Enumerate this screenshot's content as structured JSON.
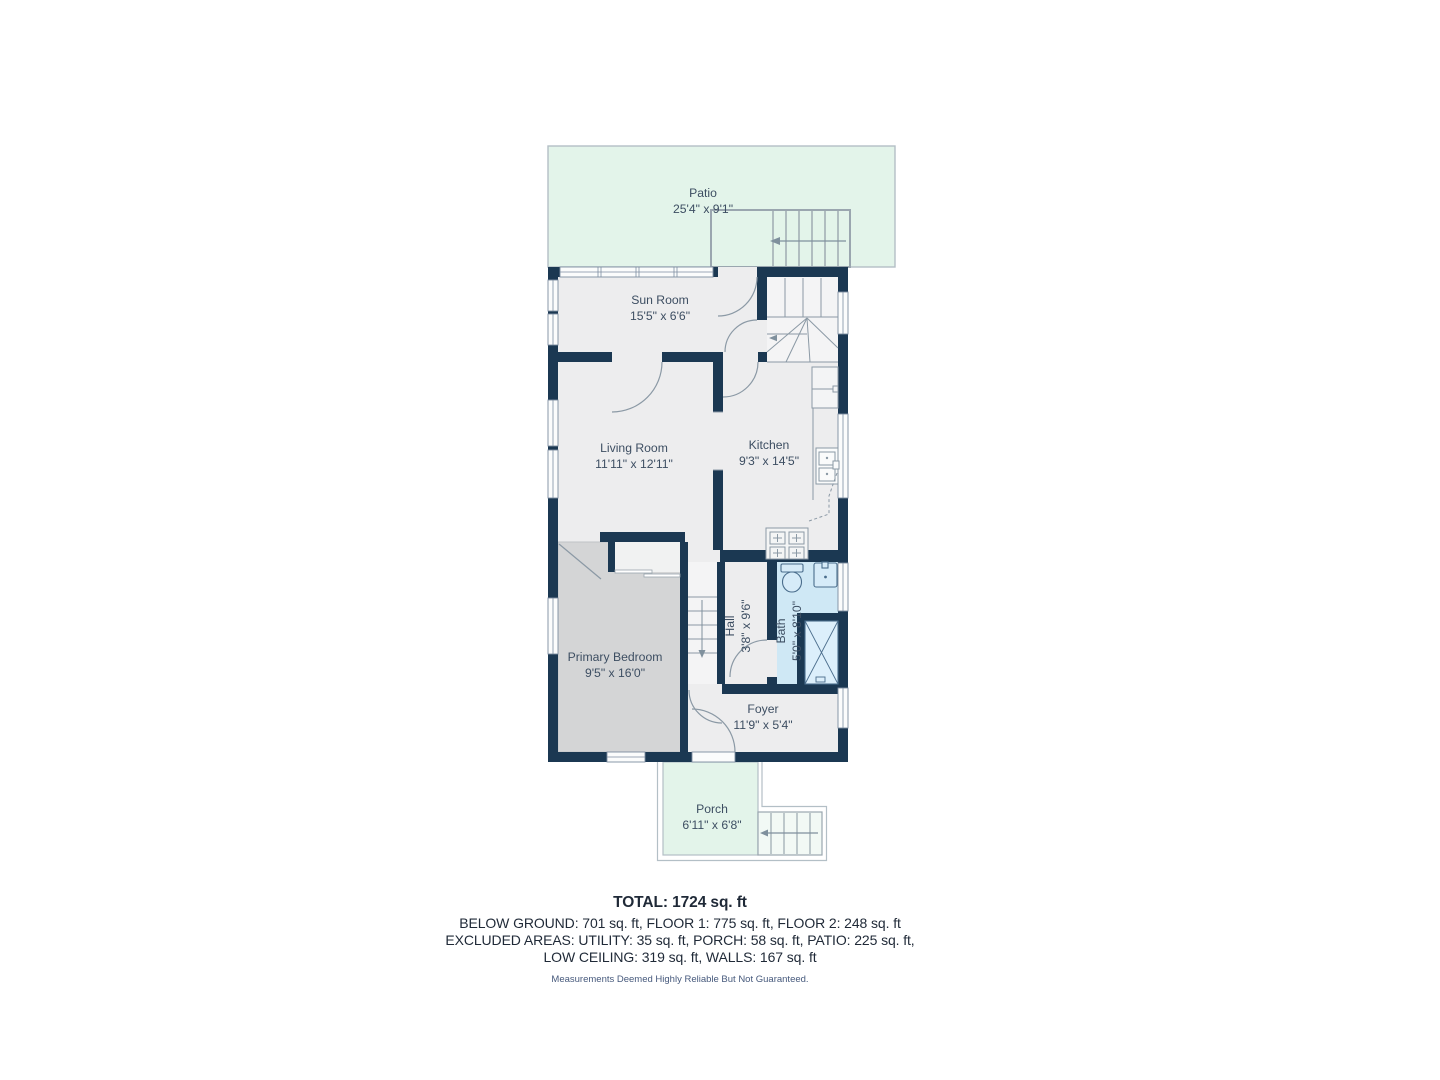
{
  "rooms": {
    "patio": {
      "name": "Patio",
      "dims": "25'4\" x 9'1\""
    },
    "sun_room": {
      "name": "Sun Room",
      "dims": "15'5\" x 6'6\""
    },
    "living_room": {
      "name": "Living Room",
      "dims": "11'11\" x 12'11\""
    },
    "kitchen": {
      "name": "Kitchen",
      "dims": "9'3\" x 14'5\""
    },
    "primary_bedroom": {
      "name": "Primary Bedroom",
      "dims": "9'5\" x 16'0\""
    },
    "hall": {
      "name": "Hall",
      "dims": "3'8\" x 9'6\""
    },
    "bath": {
      "name": "Bath",
      "dims": "5'0\" x 8'10\""
    },
    "foyer": {
      "name": "Foyer",
      "dims": "11'9\" x 5'4\""
    },
    "porch": {
      "name": "Porch",
      "dims": "6'11\" x 6'8\""
    }
  },
  "summary": {
    "total": "TOTAL: 1724 sq. ft",
    "line2": "BELOW GROUND: 701 sq. ft, FLOOR 1: 775 sq. ft, FLOOR 2: 248 sq. ft",
    "line3": "EXCLUDED AREAS: UTILITY: 35 sq. ft, PORCH: 58 sq. ft, PATIO: 225 sq. ft,",
    "line4": "LOW CEILING: 319 sq. ft, WALLS: 167 sq. ft",
    "disclaimer": "Measurements Deemed Highly Reliable But Not Guaranteed."
  },
  "colors": {
    "wall": "#1b3852",
    "floor": "#ededee",
    "bedroom_floor": "#d4d5d6",
    "bath_floor": "#cfe8f5",
    "outdoor_green": "#e3f4ea",
    "line_gray": "#8b99a5",
    "label_text": "#3d4e62"
  }
}
